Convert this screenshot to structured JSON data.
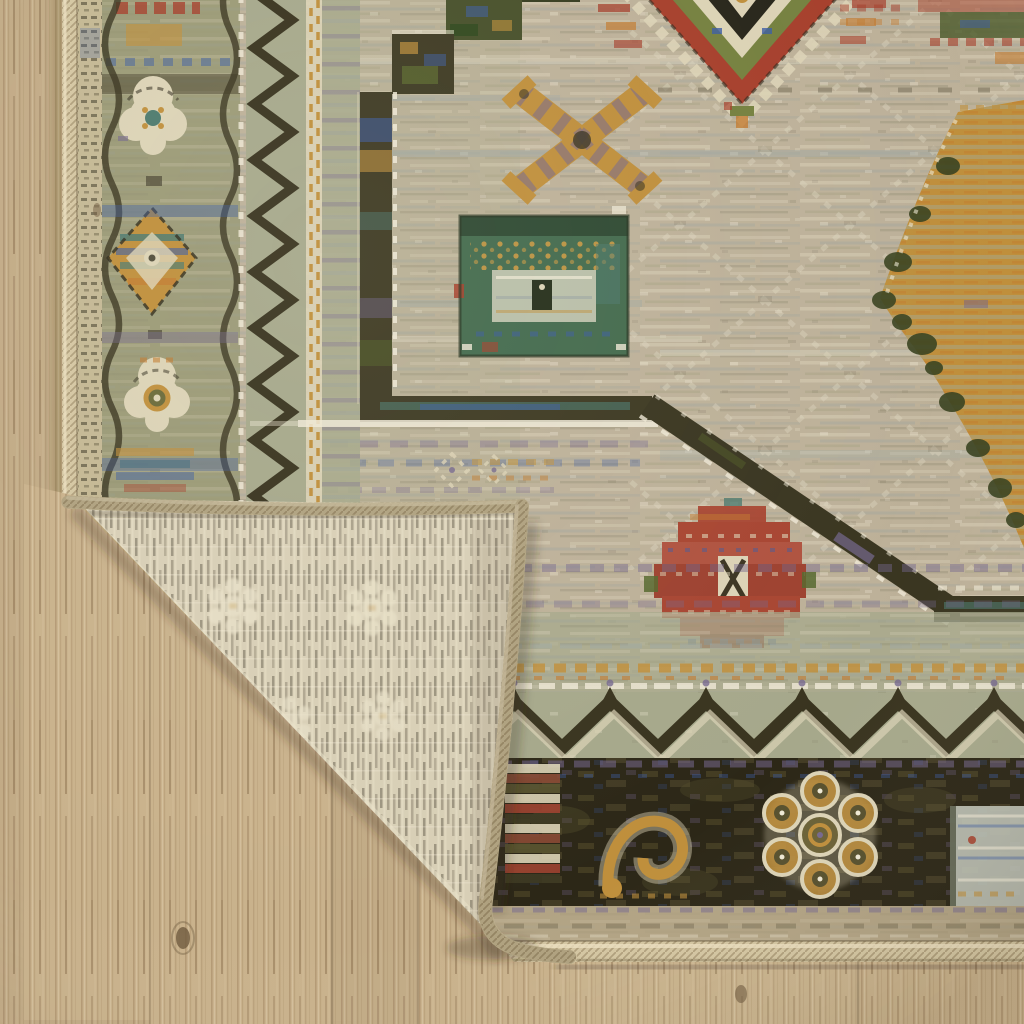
{
  "scene": {
    "type": "natural-image-photo",
    "subject": "Tribal-style area rug with its bottom-left corner folded over, exposing the ribbed cream woven backing and serged edges, lying on a light oak plank floor",
    "floor": "light wood planks, vertical grain with knots and seams",
    "rug": "beige field with olive left border, gold X motif, teal-green square medallion, stepped red diamond medallion, faint diamond lattice, dark diagonal medallion outline, rust tribal gul, chevron zigzag band and dark floral border at bottom",
    "fold": "corner flipped up showing striped backing with ghost rosettes"
  },
  "colors": {
    "wood_base": "#c9b28c",
    "wood_light": "#dbc9a7",
    "wood_grain": "#a78c63",
    "wood_seam": "#8e7a5c",
    "wood_knot": "#6f5a3f",
    "field": "#bdb199",
    "field_streak": "#9fa8a4",
    "field_cream": "#ded6c0",
    "border_ground": "#9b9a77",
    "sage_band": "#a6a88b",
    "border_dark": "#39341f",
    "cream": "#dcd3b6",
    "white_fleck": "#efe9d6",
    "gold": "#bf8f3c",
    "orange": "#c27a2f",
    "teal": "#4d7a6e",
    "blue": "#3c5da4",
    "purple": "#75688e",
    "red": "#a63f2c",
    "red_bright": "#b05340",
    "dark_band": "#2c2717",
    "olive_mottle": "#59522e",
    "tan_band": "#b2a384",
    "green_square": "#446b4e",
    "green_dark": "#32491f",
    "light_panel": "#c2c6ba",
    "backing": "#d8cfb6",
    "backing_stripe": "#857d68",
    "backing_cream": "#e9e1c8",
    "binding": "#d4c6a2",
    "binding_hi": "#ecdfc0",
    "shadow": "#3f3319"
  }
}
